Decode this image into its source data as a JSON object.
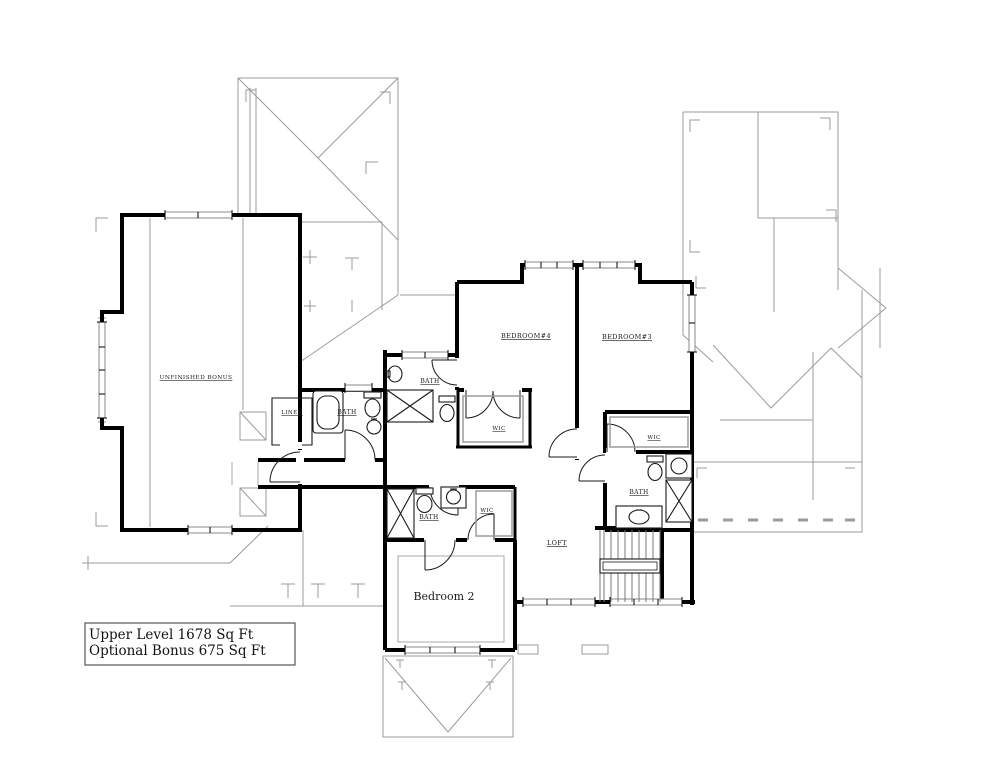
{
  "plan": {
    "title_box": {
      "line1": "Upper Level 1678 Sq Ft",
      "line2": "Optional Bonus 675 Sq Ft"
    },
    "labels": {
      "unfinished_bonus": "UNFINISHED BONUS",
      "bedroom4": "BEDROOM#4",
      "bedroom3": "BEDROOM#3",
      "bedroom2": "Bedroom 2",
      "loft": "LOFT",
      "linen": "LINEN",
      "bath_bedroom4": "BATH",
      "bath_center": "BATH",
      "bath_right": "BATH",
      "bath_hall": "BATH",
      "wic_bedroom4": "WIC",
      "wic_right": "WIC",
      "wic_hall": "WIC"
    },
    "colors": {
      "wall": "#000000",
      "roof_line": "#9b9b9b",
      "window_edge": "#8a8a8a",
      "label_text": "#1a1a1a",
      "background": "#ffffff"
    }
  }
}
